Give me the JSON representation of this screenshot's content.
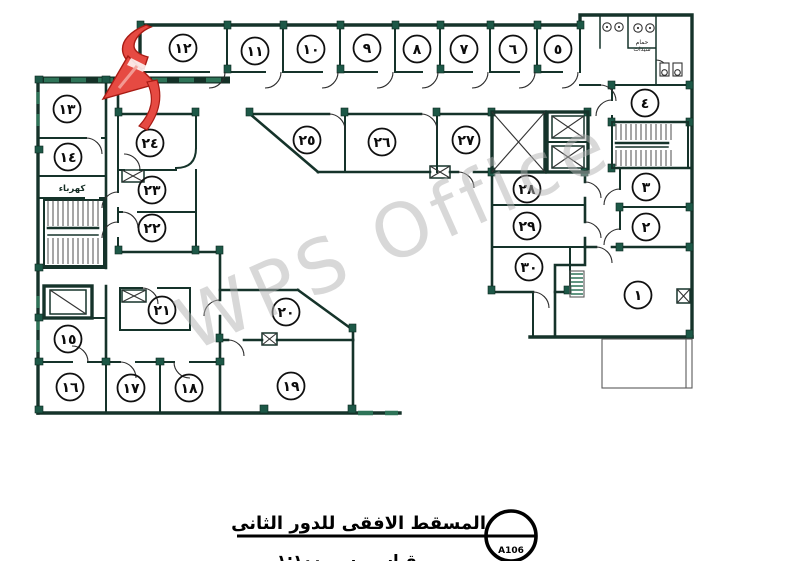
{
  "drawing": {
    "type": "architectural-floor-plan",
    "watermark": "WPS Office",
    "labels": {
      "electrical_room": "كهرباء",
      "ladies_bathroom_line1": "حمام",
      "ladies_bathroom_line2": "سيدات"
    },
    "title_block": {
      "title": "المسقط الافقى للدور الثانى",
      "scale_note": "مقياس رسم ١:١٠٠",
      "drawing_ref": "A106"
    },
    "colors": {
      "wall": "#15332a",
      "accent_green": "#2e7458",
      "arrow_red": "#e64a42",
      "watermark_gray": "#b3b3b3"
    },
    "rooms": [
      {
        "label": "١",
        "x": 638,
        "y": 295
      },
      {
        "label": "٢",
        "x": 646,
        "y": 227
      },
      {
        "label": "٣",
        "x": 646,
        "y": 187
      },
      {
        "label": "٤",
        "x": 645,
        "y": 103
      },
      {
        "label": "٥",
        "x": 558,
        "y": 49
      },
      {
        "label": "٦",
        "x": 513,
        "y": 49
      },
      {
        "label": "٧",
        "x": 464,
        "y": 49
      },
      {
        "label": "٨",
        "x": 417,
        "y": 49
      },
      {
        "label": "٩",
        "x": 367,
        "y": 48
      },
      {
        "label": "١٠",
        "x": 311,
        "y": 49
      },
      {
        "label": "١١",
        "x": 255,
        "y": 51
      },
      {
        "label": "١٢",
        "x": 183,
        "y": 48
      },
      {
        "label": "١٣",
        "x": 67,
        "y": 109
      },
      {
        "label": "١٤",
        "x": 68,
        "y": 157
      },
      {
        "label": "١٥",
        "x": 68,
        "y": 339
      },
      {
        "label": "١٦",
        "x": 70,
        "y": 387
      },
      {
        "label": "١٧",
        "x": 131,
        "y": 388
      },
      {
        "label": "١٨",
        "x": 189,
        "y": 388
      },
      {
        "label": "١٩",
        "x": 291,
        "y": 386
      },
      {
        "label": "٢٠",
        "x": 286,
        "y": 312
      },
      {
        "label": "٢١",
        "x": 162,
        "y": 310
      },
      {
        "label": "٢٢",
        "x": 152,
        "y": 228
      },
      {
        "label": "٢٣",
        "x": 152,
        "y": 190
      },
      {
        "label": "٢٤",
        "x": 150,
        "y": 143
      },
      {
        "label": "٢٥",
        "x": 307,
        "y": 140
      },
      {
        "label": "٢٦",
        "x": 382,
        "y": 142
      },
      {
        "label": "٢٧",
        "x": 466,
        "y": 140
      },
      {
        "label": "٢٨",
        "x": 527,
        "y": 189
      },
      {
        "label": "٢٩",
        "x": 527,
        "y": 226
      },
      {
        "label": "٣٠",
        "x": 529,
        "y": 267
      }
    ]
  }
}
